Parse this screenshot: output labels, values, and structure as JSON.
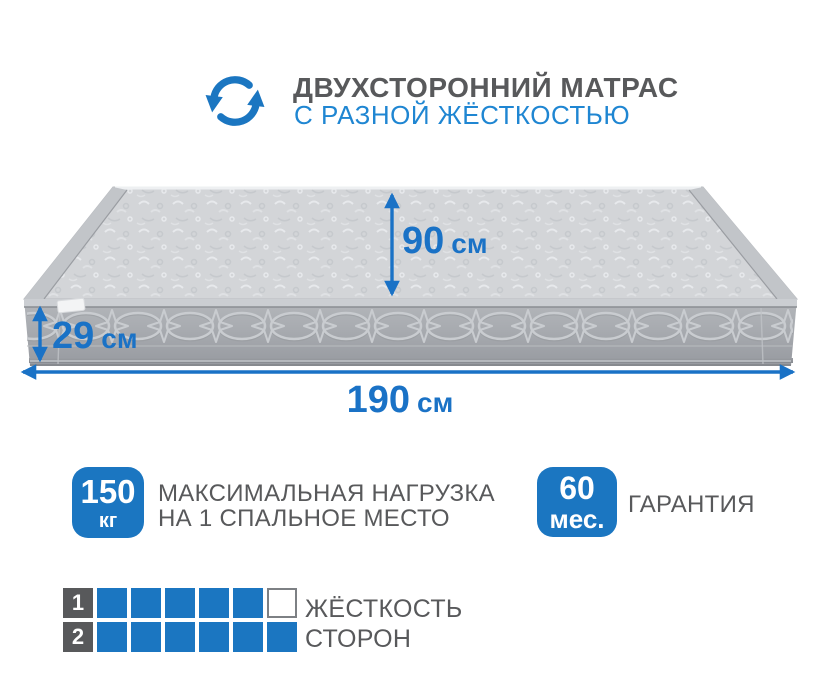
{
  "header": {
    "title": "ДВУХСТОРОННИЙ МАТРАС",
    "subtitle": "С РАЗНОЙ ЖЁСТКОСТЬЮ",
    "icon": "rotate-arrows-icon"
  },
  "mattress": {
    "depth": {
      "value": "90",
      "unit": "см"
    },
    "height": {
      "value": "29",
      "unit": "см"
    },
    "length": {
      "value": "190",
      "unit": "см"
    }
  },
  "load_badge": {
    "value": "150",
    "unit": "кг",
    "label_lines": [
      "МАКСИМАЛЬНАЯ НАГРУЗКА",
      "НА 1 СПАЛЬНОЕ МЕСТО"
    ]
  },
  "warranty_badge": {
    "value": "60",
    "unit": "мес.",
    "label": "ГАРАНТИЯ"
  },
  "firmness": {
    "caption_lines": [
      "ЖЁСТКОСТЬ",
      "СТОРОН"
    ],
    "scale_max": 6,
    "rows": [
      {
        "label": "1",
        "filled": 5,
        "total": 6
      },
      {
        "label": "2",
        "filled": 6,
        "total": 6
      }
    ]
  },
  "colors": {
    "accent_blue": "#1b76c1",
    "dimension_blue": "#1a72c6",
    "subtitle_blue": "#1f86d2",
    "text_gray": "#58595b"
  }
}
